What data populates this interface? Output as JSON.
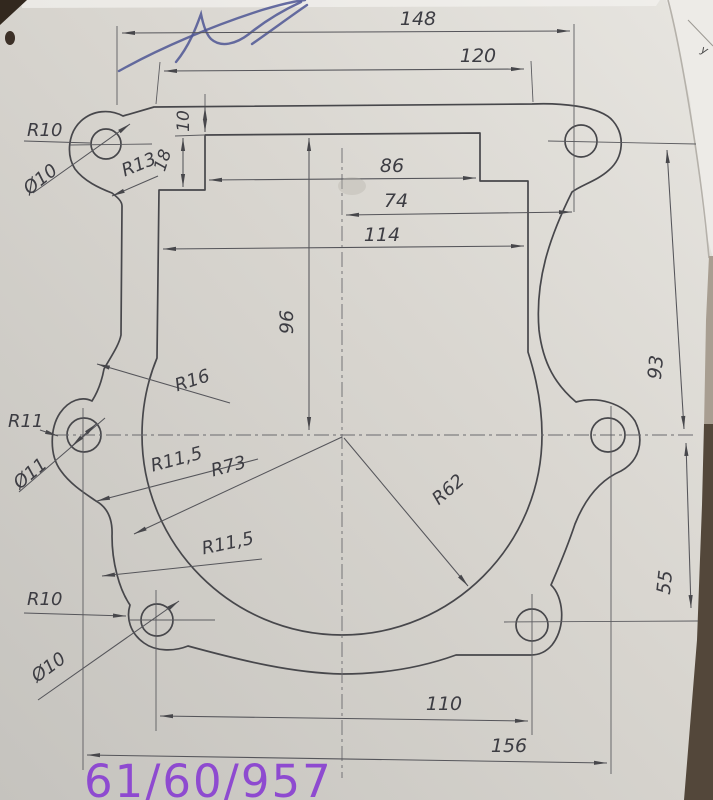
{
  "drawing": {
    "handwritten_title": "61/60/957",
    "corner_fragment_glyph": "у",
    "dims": {
      "overall_width": "148",
      "top_edge_width": "120",
      "top_step_depth": "10",
      "top_step_height": "18",
      "opening_top_width": "86",
      "center_to_right_hole": "74",
      "opening_width": "114",
      "opening_height": "96",
      "right_upper_height": "93",
      "right_lower_height": "55",
      "bottom_holes_span": "110",
      "middle_holes_span": "156"
    },
    "labels": {
      "top_left_lobe_radius": "R10",
      "top_left_hole_dia": "Ø10",
      "top_left_fillet_radius": "R13",
      "left_fillet_radius": "R16",
      "mid_left_lobe_radius": "R11",
      "mid_left_hole_dia": "Ø11",
      "left_lower_fillet_radius": "R11,5",
      "outer_bottom_radius": "R73",
      "bottom_left_fillet_radius": "R11,5",
      "bottom_left_lobe_radius": "R10",
      "bottom_left_hole_dia": "Ø10",
      "inner_bottom_radius": "R62"
    },
    "colors": {
      "paper": "#d8d5cf",
      "ink_line": "#47474b",
      "handwriting_purple": "#8e4ad0",
      "pen_blue": "#4e5694"
    }
  }
}
